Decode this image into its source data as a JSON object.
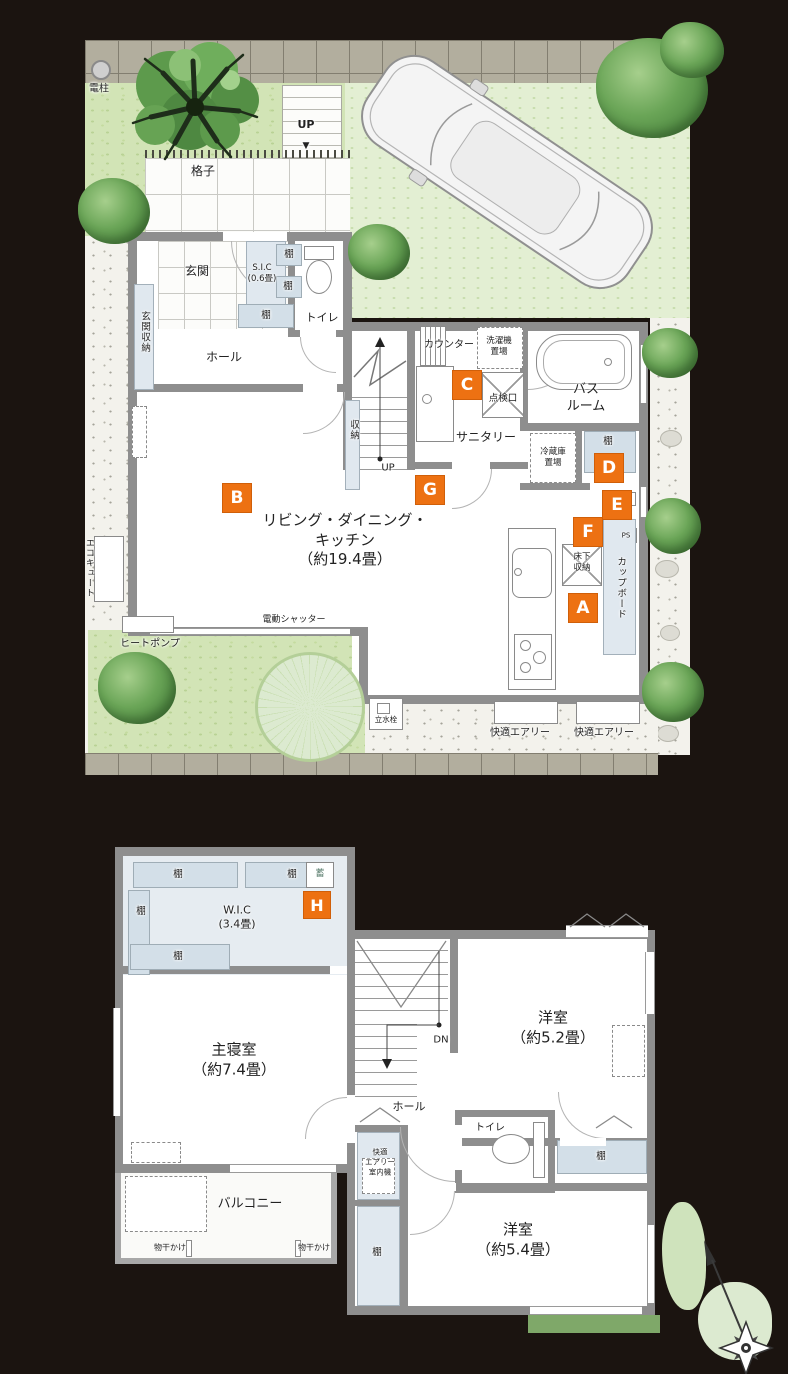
{
  "colors": {
    "marker_orange": "#ed7112",
    "wall_gray": "#8e8e8e",
    "storage_blue": "#dde6ee",
    "grass_green": "#d2e4b6",
    "lawn_green": "#e3efd3",
    "tile_gray": "#b2ae9e",
    "accent_text": "#222222"
  },
  "common": {
    "tana": "棚",
    "up": "UP",
    "down_arrow": "▼"
  },
  "markers": {
    "a": "A",
    "b": "B",
    "c": "C",
    "d": "D",
    "e": "E",
    "f": "F",
    "g": "G",
    "h": "H"
  },
  "floor1": {
    "denchu": "電柱",
    "koshi": "格子",
    "genkan": "玄関",
    "sic1": "S.I.C",
    "sic2": "(0.6畳)",
    "toire": "トイレ",
    "genkan_shuno": "玄関収納",
    "hall": "ホール",
    "shuno": "収納",
    "counter": "カウンター",
    "sentakuki1": "洗濯機",
    "sentakuki2": "置場",
    "tenkenko": "点検口",
    "bath1": "バス",
    "bath2": "ルーム",
    "sanitary": "サニタリー",
    "reizoko1": "冷蔵庫",
    "reizoko2": "置場",
    "ps": "PS",
    "yukashita1": "床下",
    "yukashita2": "収納",
    "cupboard": "カップボード",
    "ldk1": "リビング・ダイニング・",
    "ldk2": "キッチン",
    "ldk3": "（約19.4畳）",
    "ecocute": "エコキュート",
    "heatpump": "ヒートポンプ",
    "shutter": "電動シャッター",
    "rissuisen": "立水栓",
    "airy": "快適エアリー"
  },
  "floor2": {
    "chiku": "蓄",
    "wic1": "W.I.C",
    "wic2": "(3.4畳)",
    "bed1": "主寝室",
    "bed2": "（約7.4畳）",
    "dn": "DN",
    "y52_1": "洋室",
    "y52_2": "（約5.2畳）",
    "hall": "ホール",
    "toire": "トイレ",
    "airy1": "快適",
    "airy2": "エアリー",
    "airy3": "室内機",
    "y54_1": "洋室",
    "y54_2": "（約5.4畳）",
    "balcony": "バルコニー",
    "monohoshi": "物干かけ"
  }
}
